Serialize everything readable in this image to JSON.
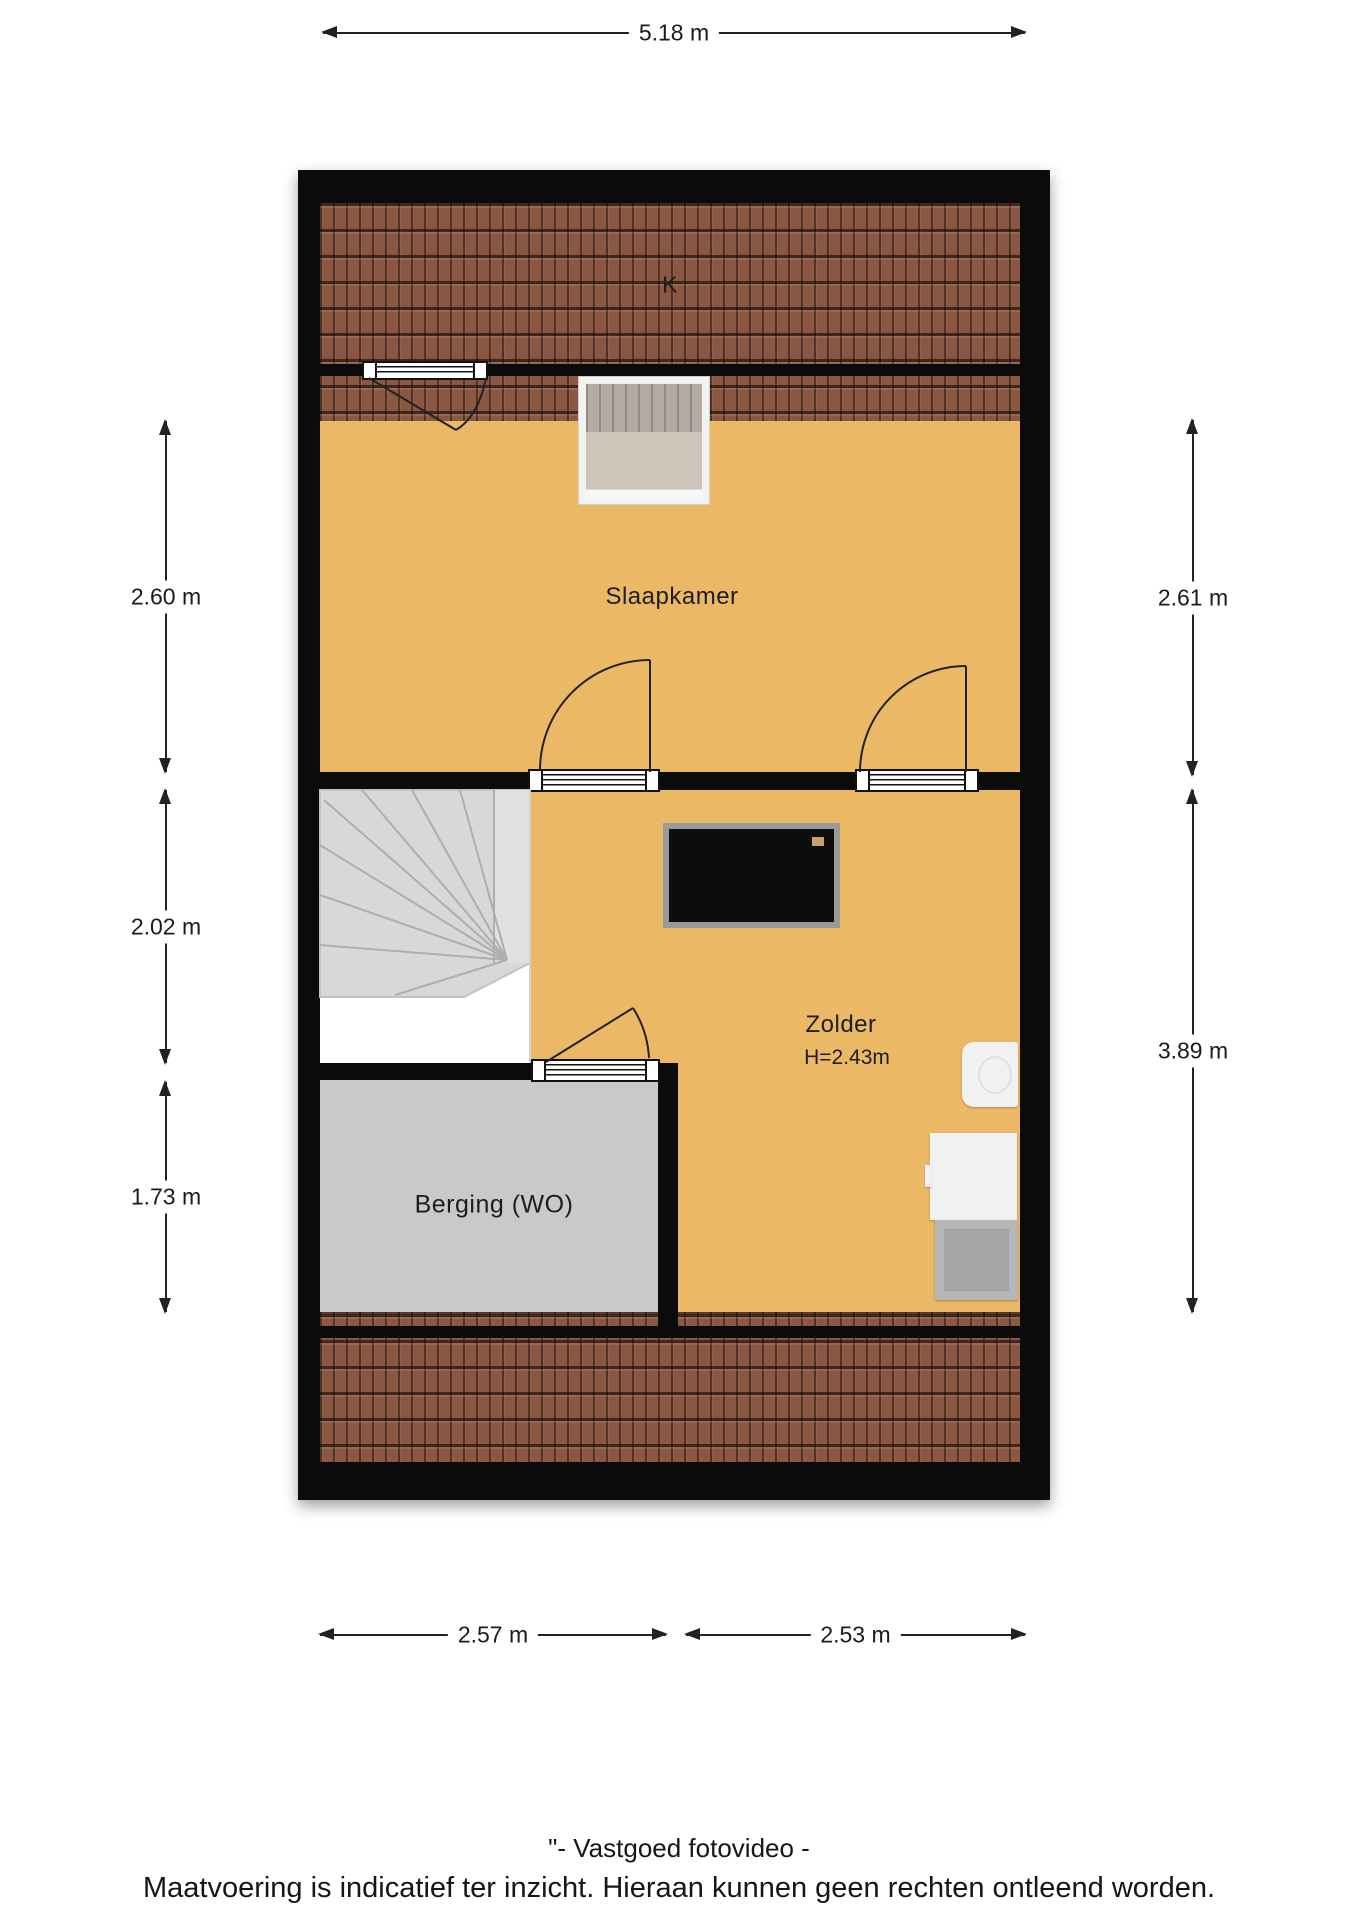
{
  "plan": {
    "rooms": [
      {
        "id": "k",
        "label": "K"
      },
      {
        "id": "slaapkamer",
        "label": "Slaapkamer"
      },
      {
        "id": "zolder",
        "label": "Zolder",
        "height": "H=2.43m"
      },
      {
        "id": "berging",
        "label": "Berging (WO)"
      }
    ]
  },
  "dimensions": {
    "top": "5.18 m",
    "left": [
      "2.60 m",
      "2.02 m",
      "1.73 m"
    ],
    "right": [
      "2.61 m",
      "3.89 m"
    ],
    "bottom": [
      "2.57 m",
      "2.53 m"
    ]
  },
  "footer": {
    "line1": "\"- Vastgoed fotovideo -",
    "line2": "Maatvoering is indicatief ter inzicht. Hieraan kunnen geen rechten ontleend worden."
  },
  "fixtures": {
    "tv": "tv-screen",
    "boiler": "boiler-unit",
    "washer": "washing-machine",
    "dryer": "appliance",
    "skylight": "roof-window",
    "stairs": "winder-staircase"
  },
  "colors": {
    "floor": "#EBB966",
    "tiles": "#8A5743",
    "storage": "#C9C9C9",
    "wall": "#0B0B0B",
    "text": "#1B1B1B"
  }
}
